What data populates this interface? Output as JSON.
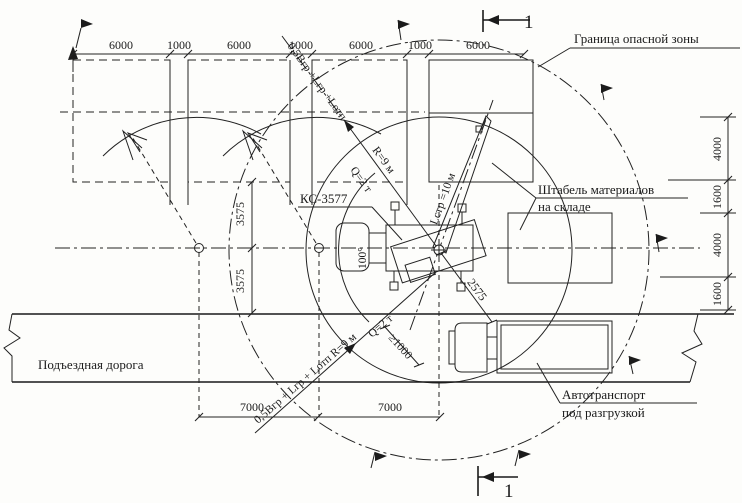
{
  "drawing": {
    "labels": {
      "danger_zone": "Граница опасной зоны",
      "stockpile_line1": "Штабель материалов",
      "stockpile_line2": "на складе",
      "road": "Подъездная дорога",
      "truck_line1": "Автотранспорт",
      "truck_line2": "под разгрузкой",
      "crane_model": "КС-3577"
    },
    "crane": {
      "boom_length": "Lстр =10 м",
      "radius": "R=9 м",
      "capacity": "Q=2 т",
      "slew_angle": "100°"
    },
    "formulas": {
      "top_diagonal": "0,5Вгр +Lгр +Lотп",
      "bottom_diagonal": "0,5Вгр + Lгр + Lотп  R=9 м",
      "bottom_capacity": "Q=2 т",
      "clearance": "≥1000"
    },
    "dims": {
      "top": [
        "6000",
        "1000",
        "6000",
        "1000",
        "6000",
        "1000",
        "6000"
      ],
      "right": [
        "4000",
        "1600",
        "4000",
        "1600"
      ],
      "left": [
        "3575",
        "3575"
      ],
      "bottom": [
        "7000",
        "7000"
      ],
      "crane_offset": "2575"
    },
    "section": {
      "top": "1",
      "bottom": "1"
    }
  }
}
